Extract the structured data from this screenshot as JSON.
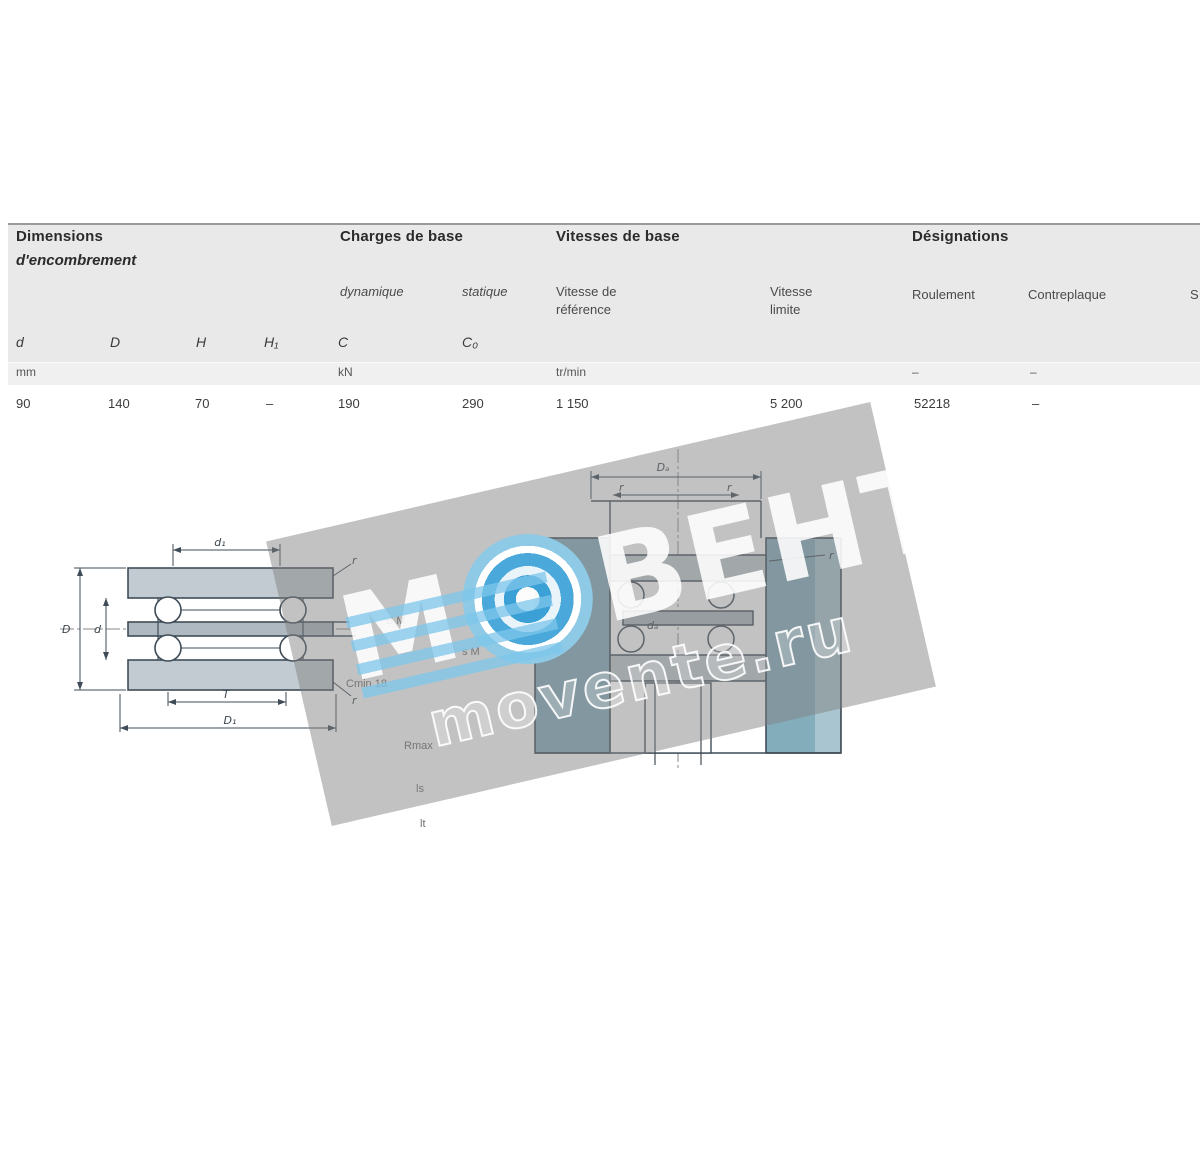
{
  "table": {
    "groups": {
      "dimensions": {
        "title": "Dimensions",
        "subtitle": "d'encombrement"
      },
      "charges": {
        "title": "Charges de base",
        "sub_dyn": "dynamique",
        "sub_stat": "statique"
      },
      "vitesses": {
        "title": "Vitesses de base",
        "ref_l1": "Vitesse de",
        "ref_l2": "référence",
        "lim_l1": "Vitesse",
        "lim_l2": "limite"
      },
      "designations": {
        "title": "Désignations",
        "sub_roul": "Roulement",
        "sub_contre": "Contreplaque",
        "clipped": "S"
      }
    },
    "symbols": {
      "d": "d",
      "D": "D",
      "H": "H",
      "H1": "H₁",
      "C": "C",
      "C0": "C₀"
    },
    "units": {
      "mm": "mm",
      "kn": "kN",
      "trmin": "tr/min",
      "dash1": "–",
      "dash2": "–"
    },
    "row": {
      "d": "90",
      "D": "140",
      "H": "70",
      "H1": "–",
      "C": "190",
      "C0": "290",
      "v_ref": "1 150",
      "v_lim": "5 200",
      "roulement": "52218",
      "contreplaque": "–"
    }
  },
  "drawings": {
    "left": {
      "dim_top": "d₁",
      "dim_left_outer": "D",
      "dim_left_inner": "d",
      "dim_bottom_inner": "T",
      "dim_bottom_outer": "D₁",
      "r_top": "r",
      "r_bottom": "r"
    },
    "right": {
      "dim_top": "Dₐ",
      "r_left": "r",
      "r_right": "r",
      "da": "dₐ",
      "r_callout": "r"
    },
    "fragments": {
      "f0": "B M",
      "f1": "s M",
      "f2": "Cmin 18",
      "f3": "Rmax",
      "f4": "ls",
      "f5": "lt"
    }
  },
  "watermark": {
    "part1": "М",
    "part2": "ВЕНТ",
    "site": "movente.ru"
  },
  "colors": {
    "band": "#e9e9e9",
    "housing": "#84adbc",
    "line": "#3f4c57",
    "logo_blue": "#3aa0d6"
  }
}
